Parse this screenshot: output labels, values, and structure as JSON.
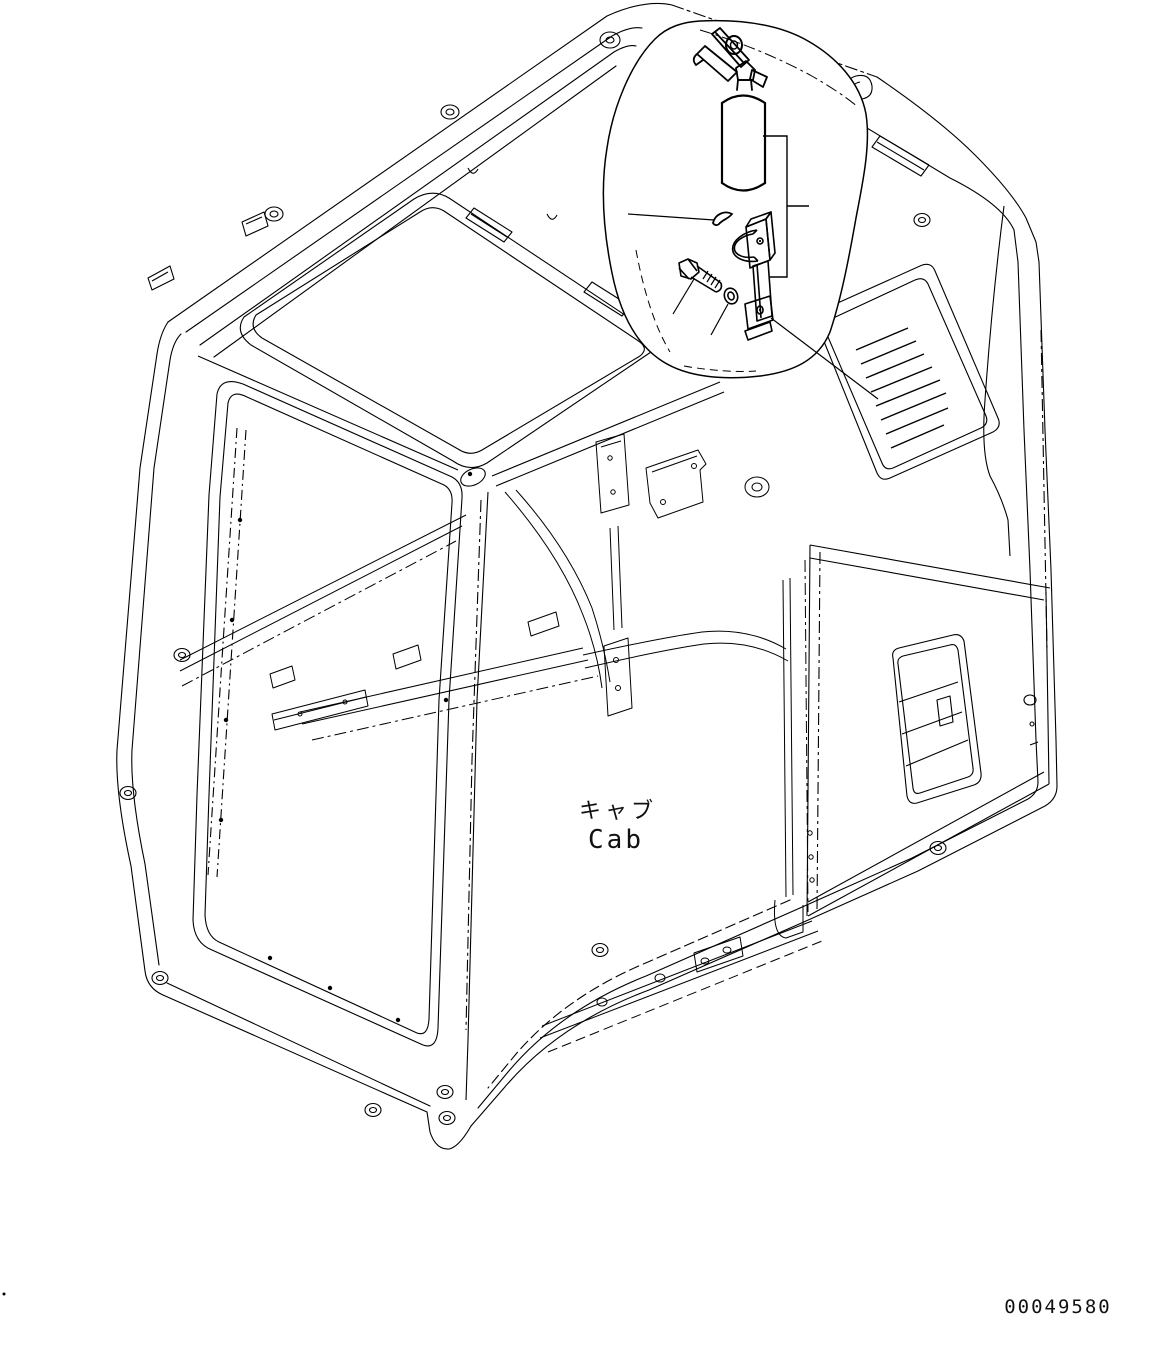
{
  "page": {
    "background": "#ffffff",
    "line_color": "#000000",
    "type": "isometric-parts-diagram"
  },
  "labels": {
    "cab_ja": "キャブ",
    "cab_en": "Cab",
    "drawing_number": "00049580"
  },
  "callout": {
    "items": [
      {
        "name": "fire-extinguisher"
      },
      {
        "name": "clamp-band-mounting-bracket"
      },
      {
        "name": "hex-bolt"
      },
      {
        "name": "washer"
      },
      {
        "name": "lock-pin"
      }
    ]
  }
}
